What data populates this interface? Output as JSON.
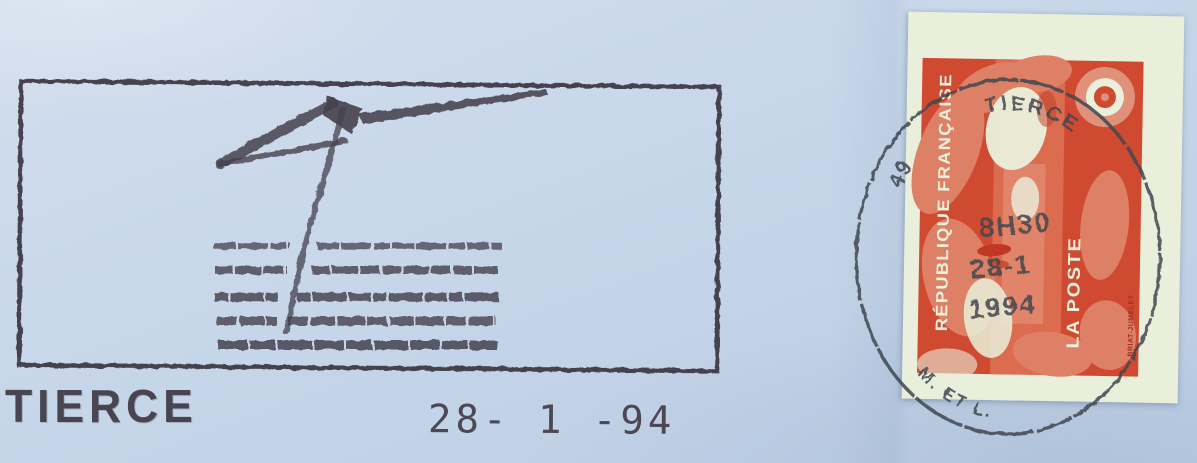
{
  "flamme": {
    "town_label": "TIERCE",
    "date_line": "28- 1 -94",
    "design_icon": "flag-over-water-lines"
  },
  "stamp": {
    "country_text": "RÉPUBLIQUE FRANÇAISE",
    "service_text": "LA POSTE",
    "engraver_text": "BRIAT-JUMELET",
    "bullseye_icon": "concentric-circles"
  },
  "postmark": {
    "dept_number": "49",
    "town": "TIERCE",
    "time": "8H30",
    "date": "28-1",
    "year": "1994",
    "region": "M. ET L."
  },
  "colors": {
    "envelope_blue": "#c7d7e9",
    "cancel_ink": "#37313c",
    "postmark_ink": "#414750",
    "stamp_paper": "#e9efda",
    "stamp_red": "#d04a31",
    "stamp_salmon": "#de8066",
    "stamp_cream": "#eaf0db"
  }
}
